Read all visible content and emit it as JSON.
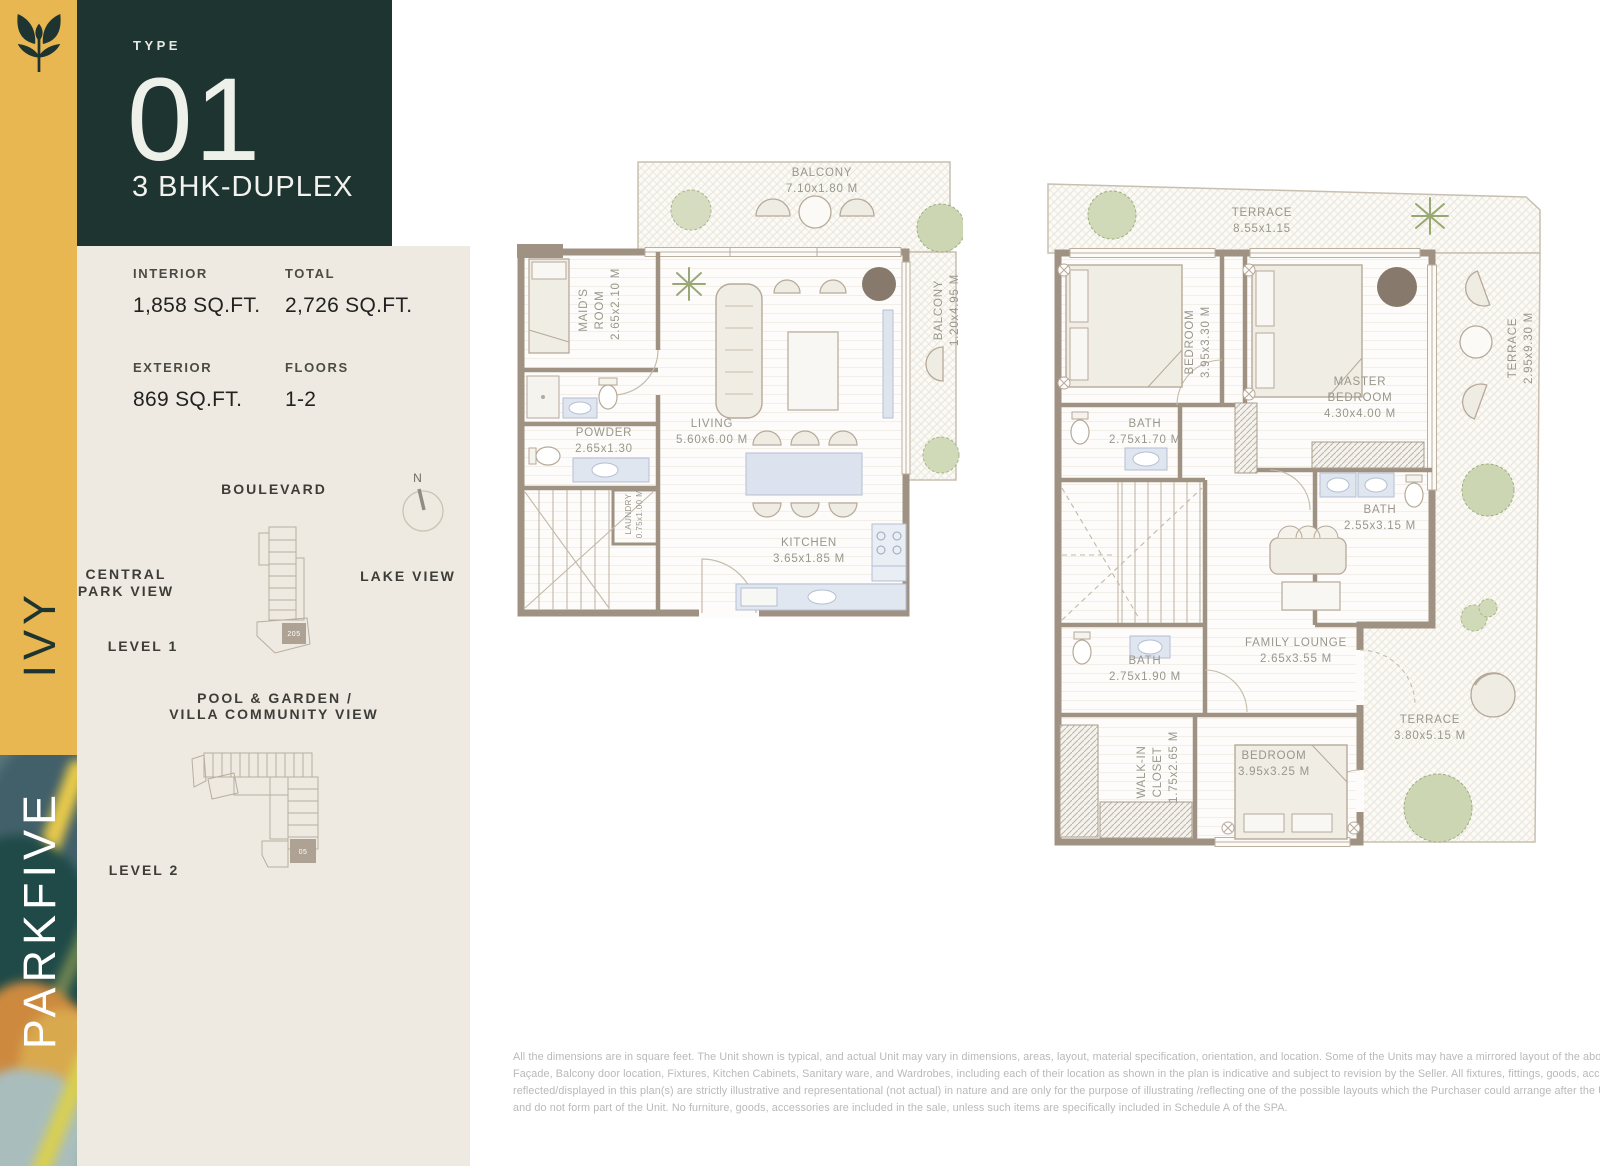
{
  "brand": {
    "vertical_top": "IVY",
    "vertical_bottom": "PARKFIVE"
  },
  "type_box": {
    "label": "TYPE",
    "number": "01",
    "subtitle": "3 BHK-DUPLEX"
  },
  "stats": {
    "items": [
      {
        "label": "INTERIOR",
        "value": "1,858 SQ.FT."
      },
      {
        "label": "TOTAL",
        "value": "2,726 SQ.FT."
      },
      {
        "label": "EXTERIOR",
        "value": "869 SQ.FT."
      },
      {
        "label": "FLOORS",
        "value": "1-2"
      }
    ]
  },
  "site": {
    "boulevard": "BOULEVARD",
    "compass_n": "N",
    "central_park_line1": "CENTRAL",
    "central_park_line2": "PARK VIEW",
    "lake_view": "LAKE VIEW",
    "level1_label": "LEVEL 1",
    "level1_unit": "205",
    "pool_line1": "POOL & GARDEN /",
    "pool_line2": "VILLA COMMUNITY VIEW",
    "level2_label": "LEVEL 2",
    "level2_unit": "05"
  },
  "plan_level1": {
    "rooms": {
      "balcony_top": {
        "name": "BALCONY",
        "dim": "7.10x1.80 M"
      },
      "maids_room": {
        "name": "MAID'S ROOM",
        "dim": "2.65x2.10 M"
      },
      "powder": {
        "name": "POWDER",
        "dim": "2.65x1.30"
      },
      "living": {
        "name": "LIVING",
        "dim": "5.60x6.00 M"
      },
      "balcony_right": {
        "name": "BALCONY",
        "dim": "1.20x4.95 M"
      },
      "laundry": {
        "name": "LAUNDRY",
        "dim": "0.75x1.00 M"
      },
      "kitchen": {
        "name": "KITCHEN",
        "dim": "3.65x1.85 M"
      }
    }
  },
  "plan_level2": {
    "rooms": {
      "terrace_top": {
        "name": "TERRACE",
        "dim": "8.55x1.15"
      },
      "bedroom_1": {
        "name": "BEDROOM",
        "dim": "3.95x3.30 M"
      },
      "master_bedroom": {
        "name": "MASTER BEDROOM",
        "dim": "4.30x4.00 M"
      },
      "terrace_right": {
        "name": "TERRACE",
        "dim": "2.95x9.30 M"
      },
      "bath_1": {
        "name": "BATH",
        "dim": "2.75x1.70 M"
      },
      "bath_2": {
        "name": "BATH",
        "dim": "2.55x3.15 M"
      },
      "bath_3": {
        "name": "BATH",
        "dim": "2.75x1.90 M"
      },
      "family_lounge": {
        "name": "FAMILY LOUNGE",
        "dim": "2.65x3.55 M"
      },
      "walk_in_closet": {
        "name": "WALK-IN CLOSET",
        "dim": "1.75x2.65 M"
      },
      "bedroom_2": {
        "name": "BEDROOM",
        "dim": "3.95x3.25 M"
      },
      "terrace_bottom": {
        "name": "TERRACE",
        "dim": "3.80x5.15 M"
      }
    }
  },
  "disclaimer": {
    "lines": [
      "All the dimensions are in square feet. The Unit shown is typical, and actual Unit may vary in dimensions, areas, layout, material specification, orientation, and location. Some of the Units may have a mirrored layout of the above plan. Unit Windows,",
      "Façade, Balcony door location, Fixtures, Kitchen Cabinets, Sanitary ware, and Wardrobes, including each of their location as shown in the plan is indicative and subject to revision by the Seller. All fixtures, fittings, goods, accessories, and furniture",
      "reflected/displayed in this plan(s) are strictly illustrative and representational (not actual) in nature and are only for the purpose of illustrating /reflecting one of the possible layouts which the Purchaser could arrange after the Unit is handed over",
      "and do not form part of the Unit. No furniture, goods, accessories are included in the sale, unless such items are specifically included in Schedule A of the SPA."
    ]
  },
  "colors": {
    "accent_yellow": "#e9b751",
    "panel_dark": "#1e3431",
    "panel_beige": "#eeeae2",
    "wall_taupe": "#a09283"
  }
}
